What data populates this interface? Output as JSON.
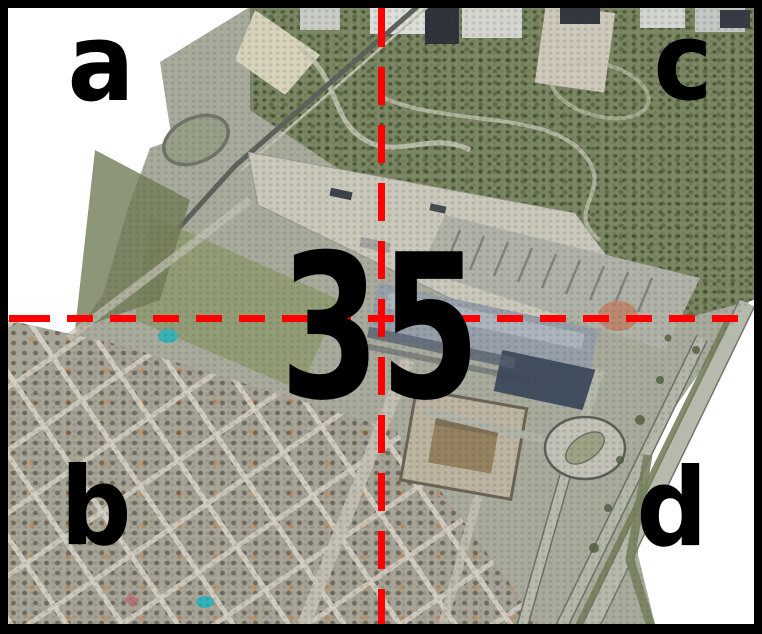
{
  "figure": {
    "sheet_number": "35",
    "quadrants": {
      "top_left": "a",
      "bottom_left": "b",
      "top_right": "c",
      "bottom_right": "d"
    },
    "colors": {
      "crosshair_red": "#ff0000",
      "label_black": "#000000",
      "frame_black": "#000000",
      "background_white": "#ffffff"
    }
  }
}
